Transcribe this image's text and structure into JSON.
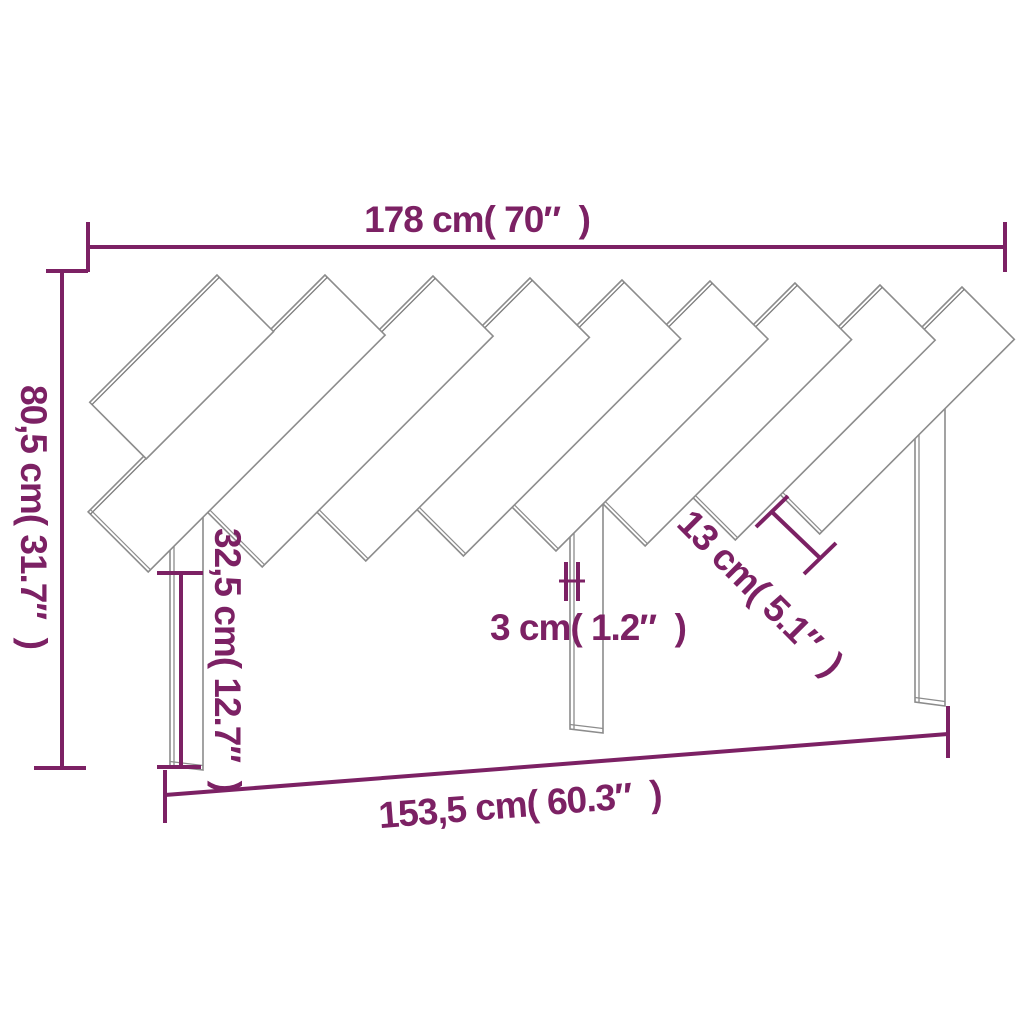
{
  "diagram": {
    "type": "product-dimension-diagram",
    "subject": "slatted wooden headboard, front view",
    "colors": {
      "dimension": "#7C2164",
      "outline": "#8C8C8C",
      "outline_dark": "#7A7A7A",
      "background": "#FFFFFF"
    },
    "dimensions": {
      "overall_width": {
        "label": "178 cm( 70″  )",
        "cm": "178",
        "inch": "70"
      },
      "overall_height": {
        "label": "80,5 cm( 31.7″  )",
        "cm": "80,5",
        "inch": "31.7"
      },
      "leg_height": {
        "label": "32,5 cm( 12.7″  )",
        "cm": "32,5",
        "inch": "12.7"
      },
      "leg_thickness": {
        "label": "3 cm( 1.2″  )",
        "cm": "3",
        "inch": "1.2"
      },
      "slat_width": {
        "label": "13 cm( 5.1″  )",
        "cm": "13",
        "inch": "5.1"
      },
      "inner_width": {
        "label": "153,5 cm( 60.3″  )",
        "cm": "153,5",
        "inch": "60.3"
      }
    }
  }
}
